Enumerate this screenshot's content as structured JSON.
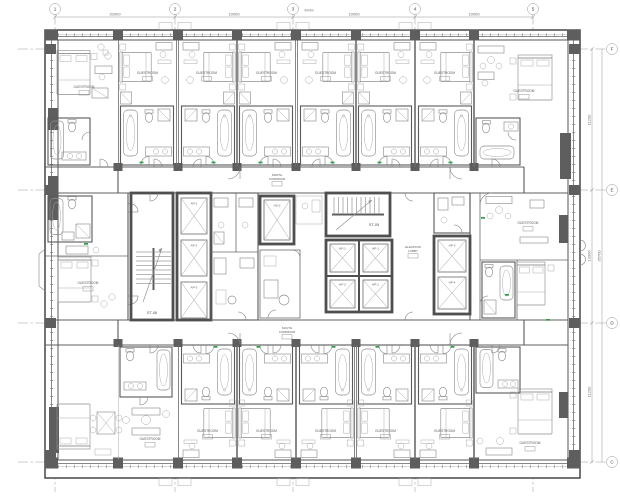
{
  "grid": {
    "top_bubbles": [
      "1",
      "2",
      "3",
      "4",
      "5"
    ],
    "right_bubbles": [
      "F",
      "E",
      "D",
      "C"
    ]
  },
  "dimensions": {
    "top": [
      "20000",
      "10000",
      "10000",
      "10000"
    ],
    "top_total": "40000",
    "right": [
      "11200",
      "13300",
      "11200"
    ],
    "right_total": "35700"
  },
  "core": {
    "stair_left": "ST-06",
    "stair_right": "ST-05",
    "lift_ap1": "AP-1",
    "lift_ap2": "AP-2",
    "lift_ap3": "AP-3",
    "lift_hs2": "HS-2",
    "lift_hf1": "HF-1",
    "lift_hf2": "HF-2",
    "lift_hp1": "HP-1",
    "lift_hp2": "HP-2",
    "lift_hp3": "HP-3",
    "lift_hp4": "HP-4"
  },
  "corridors": {
    "north": [
      "NORTH",
      "CORRIDOR"
    ],
    "south": [
      "SOUTH",
      "CORRIDOR"
    ],
    "lobby": [
      "ELEVATOR",
      "LOBBY"
    ]
  },
  "rooms": {
    "guestroom": "GUESTROOM"
  },
  "colors": {
    "wall": "#4f4f4f",
    "furniture": "#8f8f8f",
    "grid_line": "#9b9b9b",
    "accent_green": "#2f9e44",
    "dim_text": "#6e6e6e",
    "paper": "#ffffff"
  }
}
